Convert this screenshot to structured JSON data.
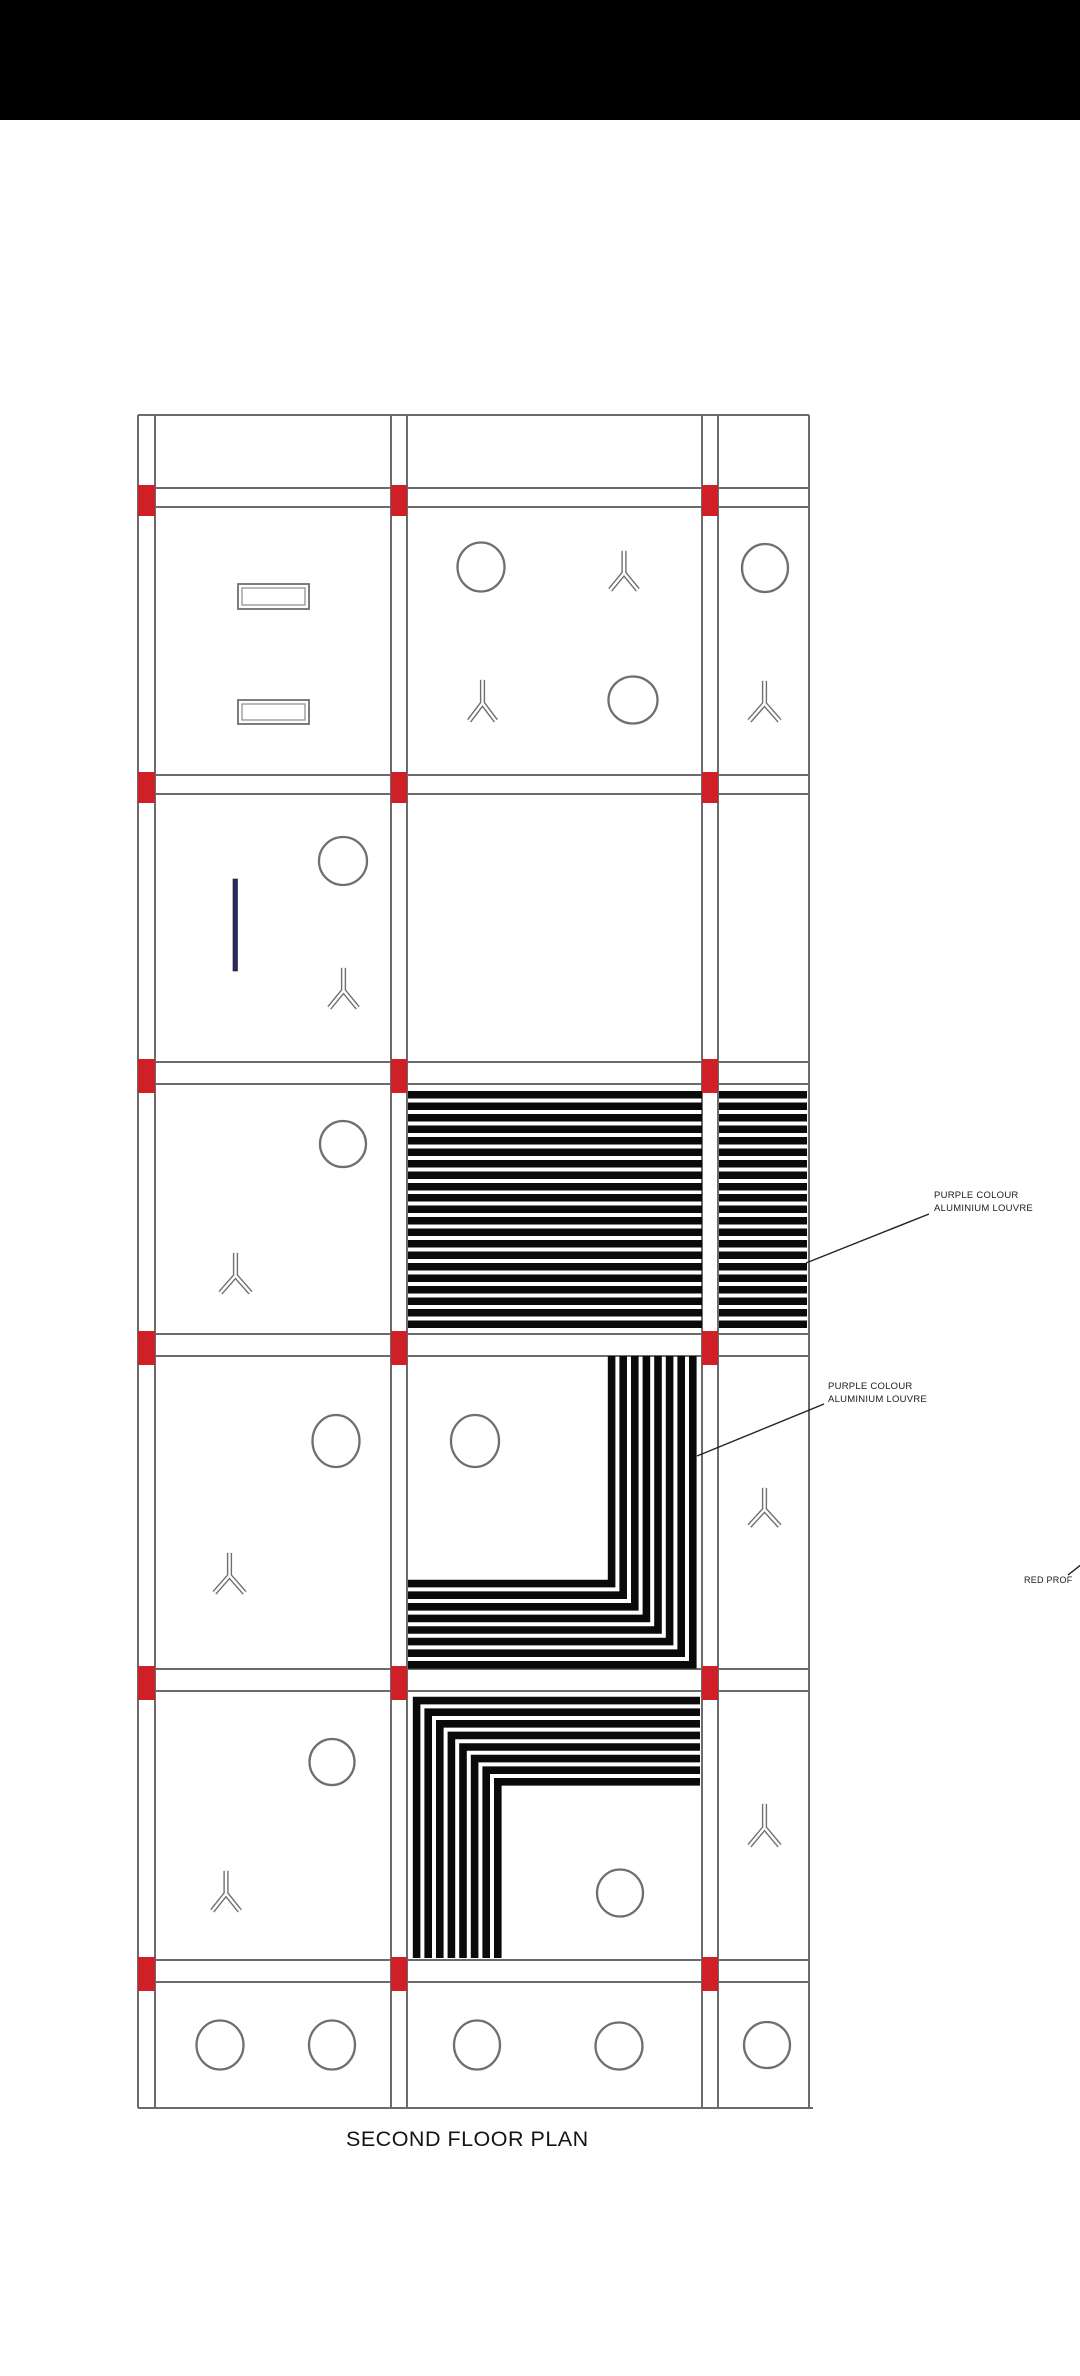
{
  "title": {
    "text": "SECOND FLOOR PLAN",
    "x": 346,
    "y": 2127,
    "font_size": 21.5
  },
  "header_bar": {
    "color": "#000000",
    "height": 120
  },
  "annotations": [
    {
      "lines": [
        "PURPLE COLOUR",
        "ALUMINIUM LOUVRE"
      ],
      "x": 934,
      "y": 1190,
      "font_size": 9.5,
      "leader": {
        "x1": 806,
        "y1": 1263,
        "x2": 929,
        "y2": 1214
      }
    },
    {
      "lines": [
        "PURPLE COLOUR",
        "ALUMINIUM LOUVRE"
      ],
      "x": 828,
      "y": 1381,
      "font_size": 9.5,
      "leader": {
        "x1": 697,
        "y1": 1456,
        "x2": 824,
        "y2": 1404
      }
    },
    {
      "lines": [
        "RED PROF",
        ""
      ],
      "x": 1024,
      "y": 1574,
      "font_size": 9,
      "leader": {
        "x1": 1068,
        "y1": 1575,
        "x2": 1082,
        "y2": 1564
      }
    }
  ],
  "colors": {
    "grid_line": "#6b6b6b",
    "symbol_line": "#6f6f6f",
    "red_marker": "#ce2026",
    "louvre_black": "#0a0a0a",
    "door_blue": "#2a2a6a",
    "leader_line": "#222222"
  },
  "plan": {
    "bounds": {
      "left": 138,
      "right": 809,
      "top": 415,
      "bottom": 2108
    },
    "v_pairs": [
      [
        138,
        155
      ],
      [
        391,
        407
      ],
      [
        702,
        718
      ]
    ],
    "right_edge": 809,
    "bands": [
      [
        488,
        507
      ],
      [
        775,
        794
      ],
      [
        1062,
        1084
      ],
      [
        1334,
        1356
      ],
      [
        1669,
        1691
      ],
      [
        1960,
        1982
      ]
    ]
  },
  "symbols": {
    "circles": [
      {
        "cx": 481,
        "cy": 567,
        "rx": 23.5,
        "ry": 24.5
      },
      {
        "cx": 633,
        "cy": 700,
        "rx": 24.5,
        "ry": 23.5
      },
      {
        "cx": 765,
        "cy": 568,
        "rx": 23,
        "ry": 24
      },
      {
        "cx": 343,
        "cy": 861,
        "rx": 24,
        "ry": 24
      },
      {
        "cx": 343,
        "cy": 1144,
        "rx": 23,
        "ry": 23
      },
      {
        "cx": 336,
        "cy": 1441,
        "rx": 23.5,
        "ry": 26
      },
      {
        "cx": 475,
        "cy": 1441,
        "rx": 24,
        "ry": 26
      },
      {
        "cx": 332,
        "cy": 1762,
        "rx": 22.5,
        "ry": 23
      },
      {
        "cx": 620,
        "cy": 1893,
        "rx": 23,
        "ry": 23.5
      },
      {
        "cx": 220,
        "cy": 2045,
        "rx": 23.5,
        "ry": 24.5
      },
      {
        "cx": 332,
        "cy": 2045,
        "rx": 23,
        "ry": 24.5
      },
      {
        "cx": 477,
        "cy": 2045,
        "rx": 23,
        "ry": 24.5
      },
      {
        "cx": 619,
        "cy": 2046,
        "rx": 23.5,
        "ry": 23.5
      },
      {
        "cx": 767,
        "cy": 2045,
        "rx": 23,
        "ry": 23
      }
    ],
    "plants": [
      {
        "x": 608,
        "y": 550,
        "w": 32,
        "h": 42
      },
      {
        "x": 467,
        "y": 679,
        "w": 31,
        "h": 44
      },
      {
        "x": 747,
        "y": 680,
        "w": 35,
        "h": 43
      },
      {
        "x": 327,
        "y": 967,
        "w": 33,
        "h": 43
      },
      {
        "x": 218,
        "y": 1252,
        "w": 35,
        "h": 43
      },
      {
        "x": 212,
        "y": 1552,
        "w": 35,
        "h": 43
      },
      {
        "x": 747,
        "y": 1487,
        "w": 35,
        "h": 41
      },
      {
        "x": 210,
        "y": 1870,
        "w": 32,
        "h": 43
      },
      {
        "x": 747,
        "y": 1803,
        "w": 35,
        "h": 45
      }
    ],
    "vents": [
      {
        "x": 238,
        "y": 584,
        "w": 71,
        "h": 25
      },
      {
        "x": 238,
        "y": 700,
        "w": 71,
        "h": 24
      }
    ],
    "door": {
      "x": 233,
      "y": 879,
      "w": 4.5,
      "h": 92
    }
  },
  "louvres": {
    "horizontal": {
      "y0": 1091,
      "count": 21,
      "pitch": 11.47,
      "bar": 7.5,
      "segments": [
        [
          408,
          702
        ],
        [
          719,
          807
        ]
      ]
    },
    "l_bottom_right": {
      "count": 8,
      "pitch": 11.6,
      "stroke": 7.6,
      "left": 408,
      "top": 1356,
      "corner_x": 611.6,
      "corner_y": 1583.6
    },
    "l_top_left": {
      "count": 8,
      "pitch": 11.6,
      "stroke": 7.6,
      "right": 700,
      "bottom": 1958,
      "corner_x": 416.6,
      "corner_y": 1700.6
    }
  }
}
